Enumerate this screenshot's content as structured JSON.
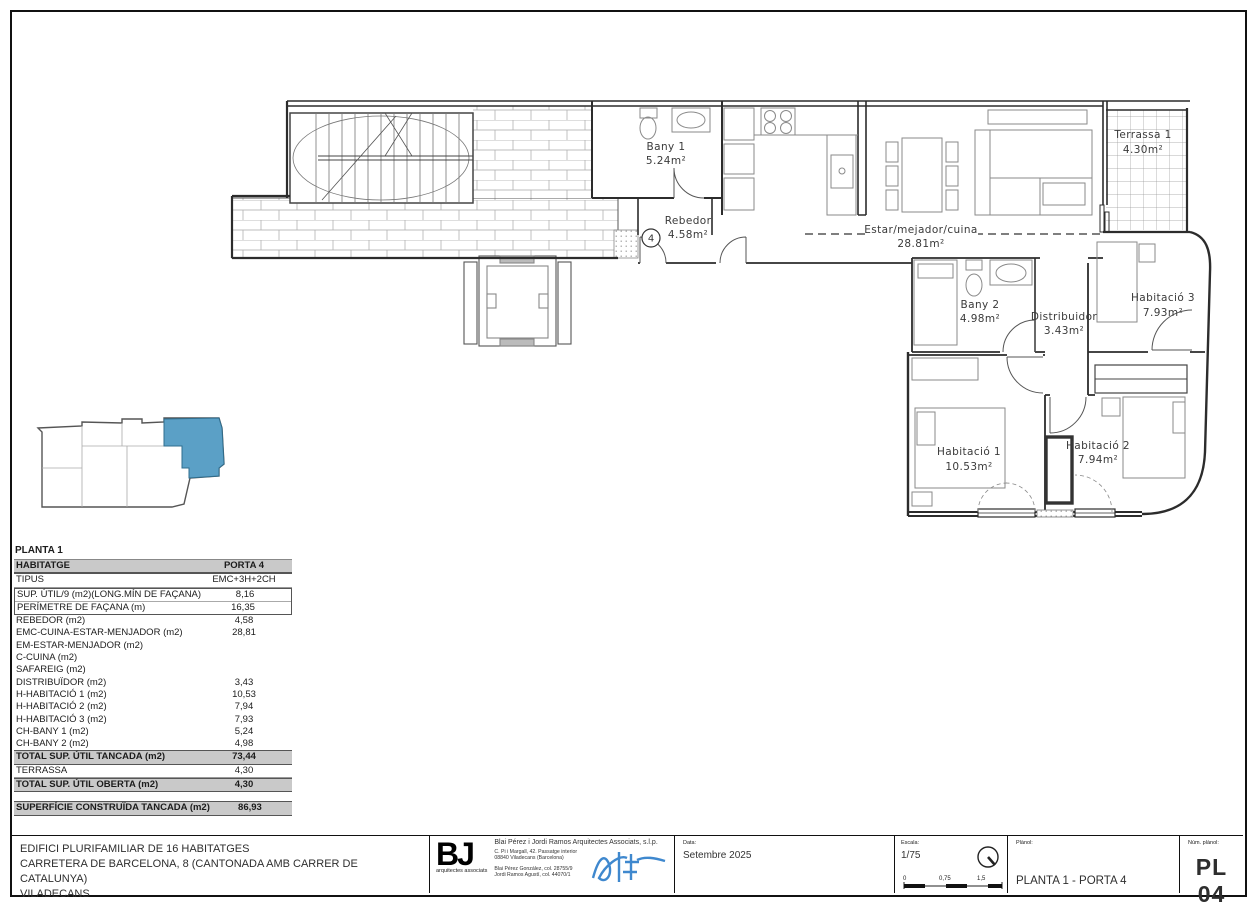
{
  "plan": {
    "entry_badge": "4",
    "rooms": [
      {
        "name": "Bany 1",
        "area": "5.24m²"
      },
      {
        "name": "Rebedor",
        "area": "4.58m²"
      },
      {
        "name": "Estar/mejador/cuina",
        "area": "28.81m²"
      },
      {
        "name": "Terrassa 1",
        "area": "4.30m²"
      },
      {
        "name": "Bany 2",
        "area": "4.98m²"
      },
      {
        "name": "Distribuidor",
        "area": "3.43m²"
      },
      {
        "name": "Habitació 3",
        "area": "7.93m²"
      },
      {
        "name": "Habitació 1",
        "area": "10.53m²"
      },
      {
        "name": "Habitació 2",
        "area": "7.94m²"
      }
    ]
  },
  "key_plan": {
    "highlight_color": "#5BA0C6"
  },
  "table": {
    "title": "PLANTA 1",
    "header": {
      "label": "HABITATGE",
      "value": "PORTA 4"
    },
    "rows": [
      {
        "label": "TIPUS",
        "value": "EMC+3H+2CH"
      },
      {
        "label": "SUP. ÚTIL/9 (m2)(LONG.MÍN DE FAÇANA)",
        "value": "8,16"
      },
      {
        "label": "PERÍMETRE DE FAÇANA (m)",
        "value": "16,35"
      },
      {
        "label": "REBEDOR (m2)",
        "value": "4,58"
      },
      {
        "label": "EMC-CUINA-ESTAR-MENJADOR (m2)",
        "value": "28,81"
      },
      {
        "label": "EM-ESTAR-MENJADOR (m2)",
        "value": ""
      },
      {
        "label": "C-CUINA (m2)",
        "value": ""
      },
      {
        "label": "SAFAREIG (m2)",
        "value": ""
      },
      {
        "label": "DISTRIBUÏDOR (m2)",
        "value": "3,43"
      },
      {
        "label": "H-HABITACIÓ 1 (m2)",
        "value": "10,53"
      },
      {
        "label": "H-HABITACIÓ 2 (m2)",
        "value": "7,94"
      },
      {
        "label": "H-HABITACIÓ 3 (m2)",
        "value": "7,93"
      },
      {
        "label": "CH-BANY 1 (m2)",
        "value": "5,24"
      },
      {
        "label": "CH-BANY 2 (m2)",
        "value": "4,98"
      },
      {
        "label": "TOTAL SUP. ÚTIL TANCADA (m2)",
        "value": "73,44"
      },
      {
        "label": "TERRASSA",
        "value": "4,30"
      },
      {
        "label": "TOTAL SUP. ÚTIL OBERTA (m2)",
        "value": "4,30"
      }
    ],
    "summary": {
      "label": "SUPERFÍCIE CONSTRUÏDA TANCADA (m2)",
      "value": "86,93"
    }
  },
  "title_block": {
    "project_line_1": "EDIFICI PLURIFAMILIAR DE 16 HABITATGES",
    "project_line_2": "CARRETERA DE BARCELONA, 8 (CANTONADA AMB CARRER DE CATALUNYA)",
    "project_line_3": "VILADECANS",
    "architect": {
      "logo": "BJ",
      "logo_sub": "arquitectes associats",
      "firm": "Blai Pérez i Jordi Ramos Arquitectes Associats, s.l.p.",
      "address_1": "C. Pi i Margall, 42. Passatge interior",
      "address_2": "08840 Viladecans (Barcelona)",
      "col_1": "Blai Pérez González, col. 28755/9",
      "col_2": "Jordi Ramos Agustí, col. 44070/1"
    },
    "date": {
      "label": "Data:",
      "value": "Setembre 2025"
    },
    "scale": {
      "label": "Escala:",
      "value": "1/75",
      "tick_0": "0",
      "tick_1": "0,75",
      "tick_2": "1,5"
    },
    "sheet": {
      "label": "Plànol:",
      "value": "PLANTA 1 - PORTA 4"
    },
    "number": {
      "label": "Núm. plànol:",
      "value": "PL 04"
    }
  }
}
